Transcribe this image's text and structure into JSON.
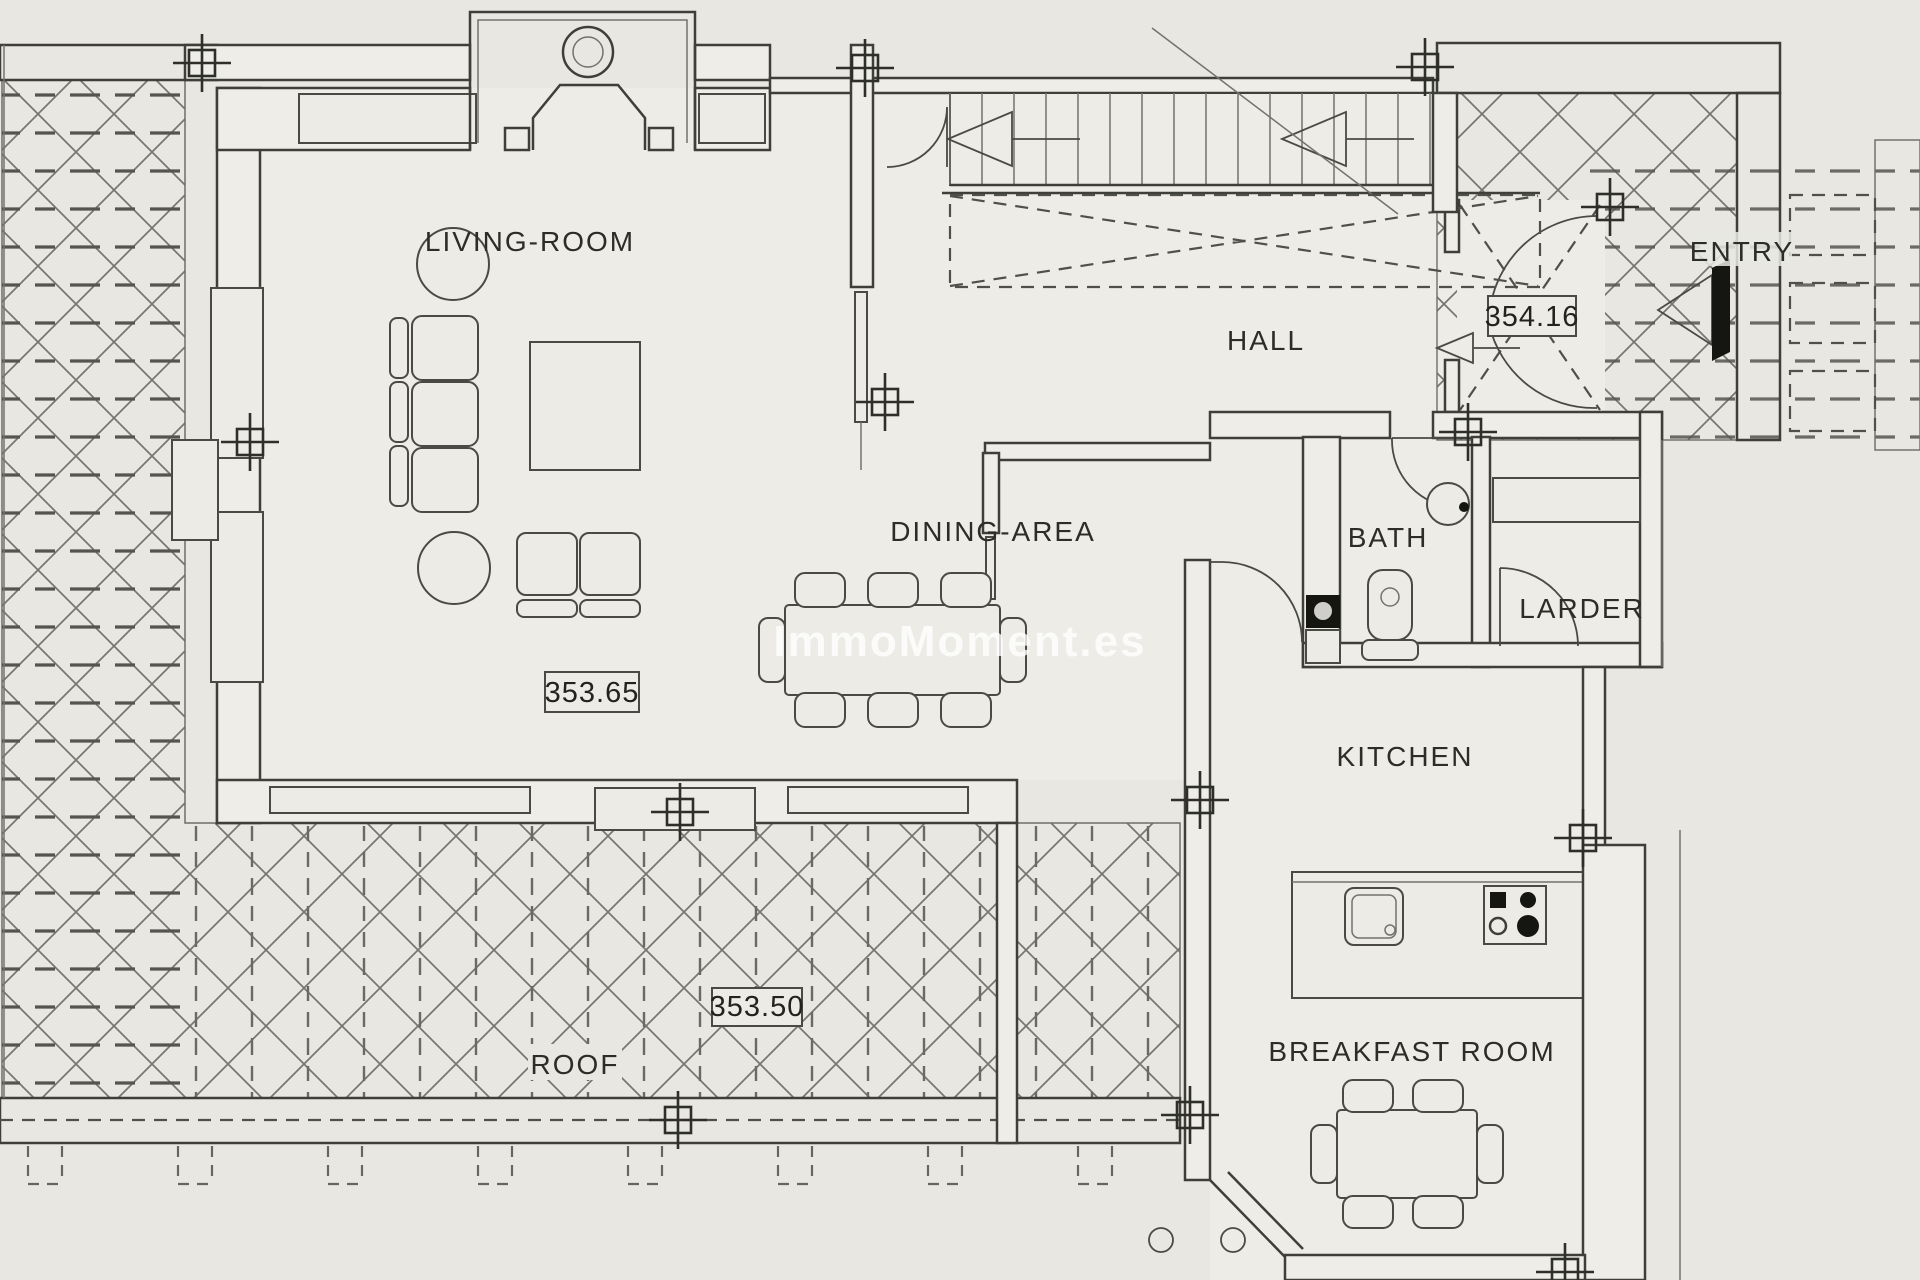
{
  "plan": {
    "watermark": "ImmoMoment.es",
    "rooms": {
      "living_room": "LIVING-ROOM",
      "hall": "HALL",
      "dining_area": "DINING-AREA",
      "bath": "BATH",
      "larder": "LARDER",
      "kitchen": "KITCHEN",
      "breakfast_room": "BREAKFAST ROOM",
      "entry": "ENTRY",
      "roof": "ROOF"
    },
    "elevations": {
      "entry_level": "354.16",
      "main_level": "353.65",
      "roof_level": "353.50"
    },
    "colors": {
      "paper": "#e8e7e2",
      "line": "#3f3f3a",
      "hatch": "#76766e",
      "black": "#151512",
      "watermark_fill": "rgba(255,255,255,0.78)"
    }
  }
}
